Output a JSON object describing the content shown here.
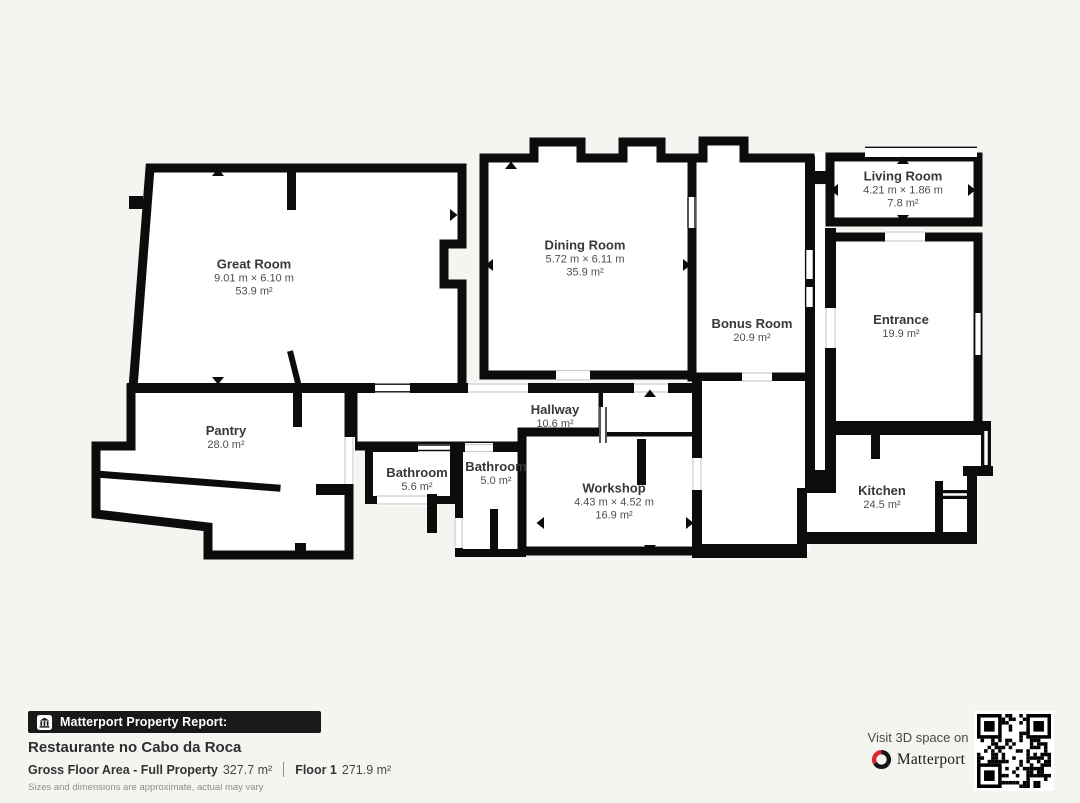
{
  "floorplan": {
    "rooms": [
      {
        "name": "Great Room",
        "dims": "9.01 m × 6.10 m",
        "area": "53.9 m²"
      },
      {
        "name": "Dining Room",
        "dims": "5.72 m × 6.11 m",
        "area": "35.9 m²"
      },
      {
        "name": "Bonus Room",
        "area": "20.9 m²"
      },
      {
        "name": "Living Room",
        "dims": "4.21 m × 1.86 m",
        "area": "7.8 m²"
      },
      {
        "name": "Entrance",
        "area": "19.9 m²"
      },
      {
        "name": "Pantry",
        "area": "28.0 m²"
      },
      {
        "name": "Hallway",
        "area": "10.6 m²"
      },
      {
        "name": "Bathroom",
        "area": "5.6 m²"
      },
      {
        "name": "Bathroom",
        "area": "5.0 m²"
      },
      {
        "name": "Workshop",
        "dims": "4.43 m × 4.52 m",
        "area": "16.9 m²"
      },
      {
        "name": "Kitchen",
        "area": "24.5 m²"
      }
    ]
  },
  "footer": {
    "report_label": "Matterport Property Report:",
    "property_name": "Restaurante no Cabo da Roca",
    "gross_label": "Gross Floor Area - Full Property",
    "gross_value": "327.7 m²",
    "floor_label": "Floor 1",
    "floor_value": "271.9 m²",
    "disclaimer": "Sizes and dimensions are approximate, actual may vary"
  },
  "cta": {
    "line": "Visit 3D space on",
    "brand": "Matterport"
  },
  "colors": {
    "background": "#f4f4f1",
    "wall": "#0c0c0c",
    "floor": "#ffffff",
    "brand_red": "#e0232e",
    "bar_background": "#191919"
  }
}
